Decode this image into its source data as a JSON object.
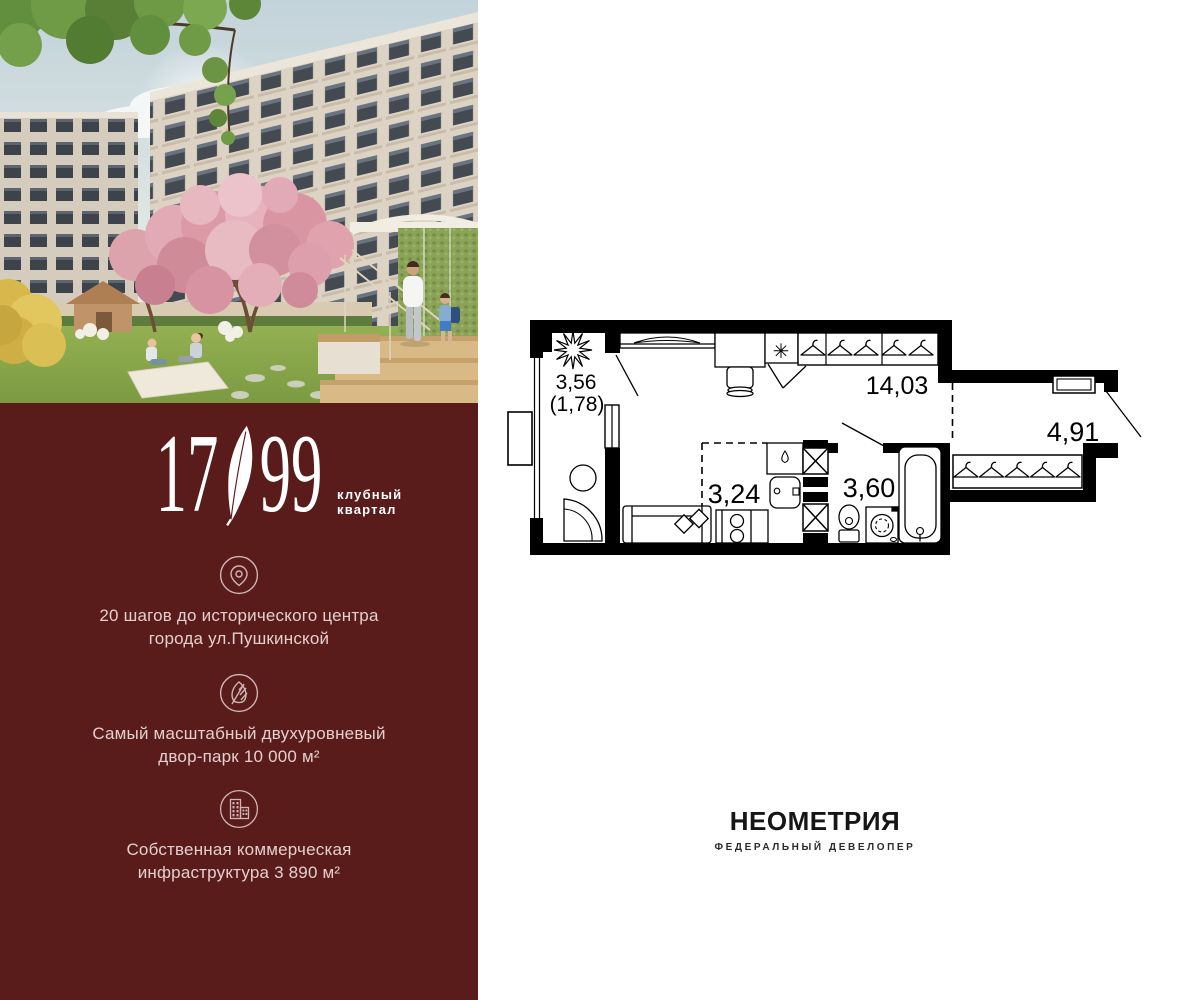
{
  "brand": {
    "number_left": "17",
    "number_right": "99",
    "tagline_line1": "клубный",
    "tagline_line2": "квартал"
  },
  "panel": {
    "bg_color": "#5A1B1B",
    "text_color": "#E2D0CE",
    "features": [
      {
        "icon": "location-pin-icon",
        "line1": "20 шагов до исторического центра",
        "line2": "города ул.Пушкинской"
      },
      {
        "icon": "leaf-icon",
        "line1": "Самый масштабный двухуровневый",
        "line2": "двор-парк 10 000 м²"
      },
      {
        "icon": "buildings-icon",
        "line1": "Собственная коммерческая",
        "line2": "инфраструктура 3 890 м²"
      }
    ]
  },
  "floorplan": {
    "wall_color": "#000000",
    "labels": {
      "loggia_area": "3,56",
      "loggia_area_reduced": "(1,78)",
      "living_area": "14,03",
      "kitchen_area": "3,24",
      "bathroom_area": "3,60",
      "hallway_area": "4,91",
      "stove_symbol": "✳"
    }
  },
  "developer": {
    "name": "НЕОМЕТРИЯ",
    "subtitle": "ФЕДЕРАЛЬНЫЙ ДЕВЕЛОПЕР"
  }
}
